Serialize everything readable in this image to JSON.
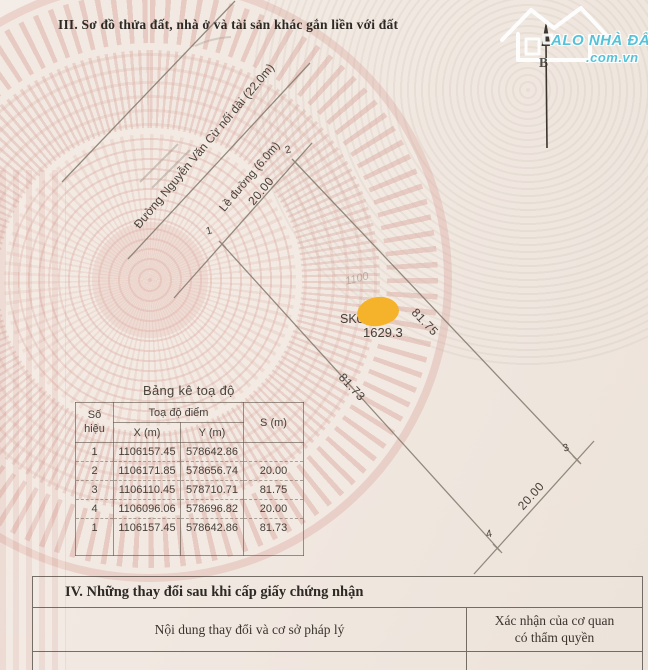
{
  "page": {
    "section3_title": "III. Sơ đồ thửa đất, nhà ở và tài sản khác gắn liền với đất",
    "section4_title": "IV. Những thay đổi sau khi cấp giấy chứng nhận",
    "change_content_label": "Nội dung thay đổi và cơ sở pháp lý",
    "authority_label_line1": "Xác nhận của cơ quan",
    "authority_label_line2": "có thẩm quyền"
  },
  "watermark_logo": {
    "brand": "ALO NHÀ ĐẤT",
    "domain": ".com.vn",
    "brand_color": "#54c2d8",
    "house_icon": "house-icon"
  },
  "diagram": {
    "north_label": "B",
    "road_label": "Đường Nguyễn Văn Cừ nối dài (22.0m)",
    "sidewalk_label": "Lề đường (6.0m)",
    "front_dim": "20.00",
    "right_dim": "81.75",
    "left_dim": "81.73",
    "back_dim": "20.00",
    "parcel_code": "SK0",
    "parcel_area": "1629.3",
    "ghost_note": "1100",
    "point_1": "1",
    "point_2": "2",
    "point_3": "3",
    "point_4": "4",
    "redaction_color": "#f5b22b"
  },
  "coord_table": {
    "title": "Bảng kê toạ độ",
    "col_point": "Số\nhiệu",
    "col_group": "Toạ độ điểm",
    "col_x": "X (m)",
    "col_y": "Y (m)",
    "col_s": "S (m)",
    "rows": [
      {
        "id": "1",
        "x": "1106157.45",
        "y": "578642.86",
        "s": ""
      },
      {
        "id": "2",
        "x": "1106171.85",
        "y": "578656.74",
        "s": "20.00"
      },
      {
        "id": "3",
        "x": "1106110.45",
        "y": "578710.71",
        "s": "81.75"
      },
      {
        "id": "4",
        "x": "1106096.06",
        "y": "578696.82",
        "s": "20.00"
      },
      {
        "id": "1",
        "x": "1106157.45",
        "y": "578642.86",
        "s": "81.73"
      }
    ]
  }
}
